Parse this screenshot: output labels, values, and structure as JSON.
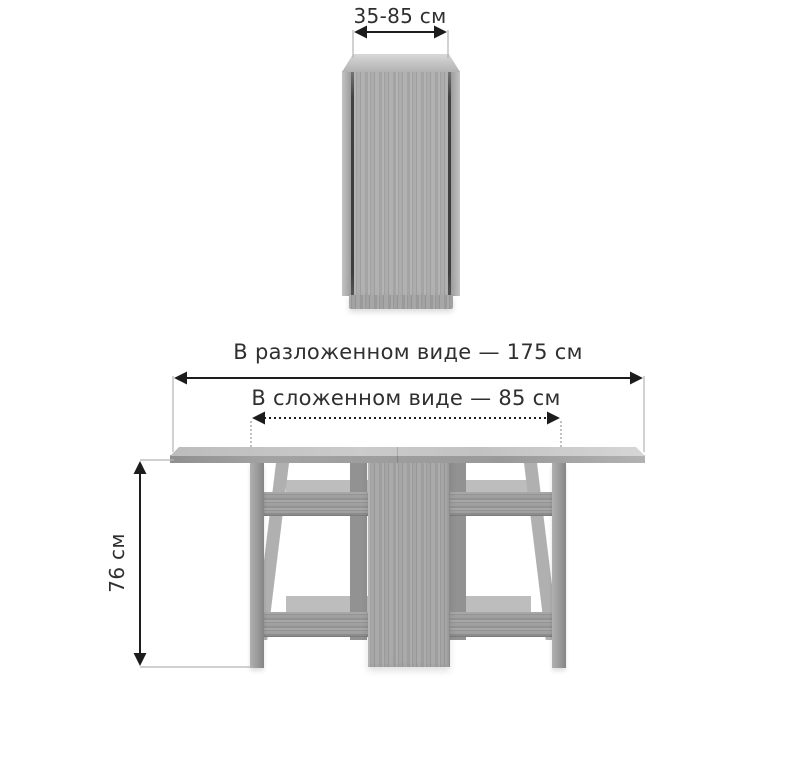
{
  "labels": {
    "folded_top_width": "35-85 см",
    "unfolded_width": "В разложенном виде — 175 см",
    "folded_width": "В сложенном виде — 85 см",
    "height": "76 см"
  },
  "colors": {
    "background": "#ffffff",
    "text": "#2f2f2f",
    "dimension_line": "#1c1c1c",
    "extension_line": "#b3b3b3",
    "wood_gray": "#a7a7a7"
  }
}
